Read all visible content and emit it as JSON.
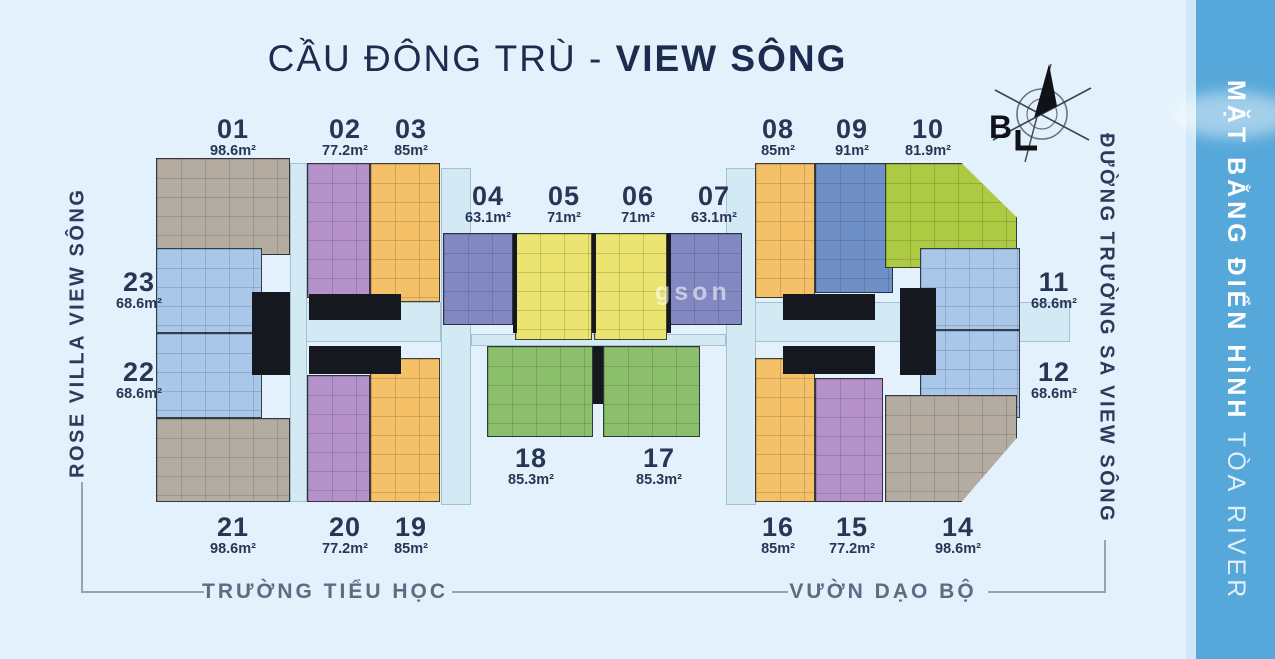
{
  "title": {
    "prefix": "CẦU ĐÔNG TRÙ - ",
    "emphasis": "VIEW SÔNG"
  },
  "compass": {
    "north_label": "B"
  },
  "street_labels": {
    "left_vertical": "ROSE VILLA VIEW SÔNG",
    "right_vertical": "ĐƯỜNG TRƯỜNG SA VIEW SÔNG",
    "bottom_left": "TRƯỜNG TIỂU HỌC",
    "bottom_right": "VƯỜN DẠO BỘ"
  },
  "side_banner": {
    "title_bold": "MẶT BẰNG ĐIỂN HÌNH",
    "title_light": " TÒA RIVER"
  },
  "watermark": "gson",
  "units": [
    {
      "no": "01",
      "area": "98.6m²",
      "color": "#b4aca0"
    },
    {
      "no": "02",
      "area": "77.2m²",
      "color": "#b492c9"
    },
    {
      "no": "03",
      "area": "85m²",
      "color": "#f4c169"
    },
    {
      "no": "04",
      "area": "63.1m²",
      "color": "#8289c2"
    },
    {
      "no": "05",
      "area": "71m²",
      "color": "#ece470"
    },
    {
      "no": "06",
      "area": "71m²",
      "color": "#ece470"
    },
    {
      "no": "07",
      "area": "63.1m²",
      "color": "#8289c2"
    },
    {
      "no": "08",
      "area": "85m²",
      "color": "#f4c169"
    },
    {
      "no": "09",
      "area": "91m²",
      "color": "#6e90c7"
    },
    {
      "no": "10",
      "area": "81.9m²",
      "color": "#adca43"
    },
    {
      "no": "11",
      "area": "68.6m²",
      "color": "#a9c8e9"
    },
    {
      "no": "12",
      "area": "68.6m²",
      "color": "#a9c8e9"
    },
    {
      "no": "14",
      "area": "98.6m²",
      "color": "#b4aca0"
    },
    {
      "no": "15",
      "area": "77.2m²",
      "color": "#b492c9"
    },
    {
      "no": "16",
      "area": "85m²",
      "color": "#f4c169"
    },
    {
      "no": "17",
      "area": "85.3m²",
      "color": "#8cbf6b"
    },
    {
      "no": "18",
      "area": "85.3m²",
      "color": "#8cbf6b"
    },
    {
      "no": "19",
      "area": "85m²",
      "color": "#f4c169"
    },
    {
      "no": "20",
      "area": "77.2m²",
      "color": "#b492c9"
    },
    {
      "no": "21",
      "area": "98.6m²",
      "color": "#b4aca0"
    },
    {
      "no": "22",
      "area": "68.6m²",
      "color": "#a9c8e9"
    },
    {
      "no": "23",
      "area": "68.6m²",
      "color": "#a9c8e9"
    }
  ],
  "colors": {
    "background": "#e2f1fb",
    "banner": "#57a8da",
    "title_text": "#1d2c4e",
    "label_text": "#263654",
    "bottom_text": "#5d6c82",
    "corridor": "#d3eaf4",
    "core_black": "#16181f"
  }
}
